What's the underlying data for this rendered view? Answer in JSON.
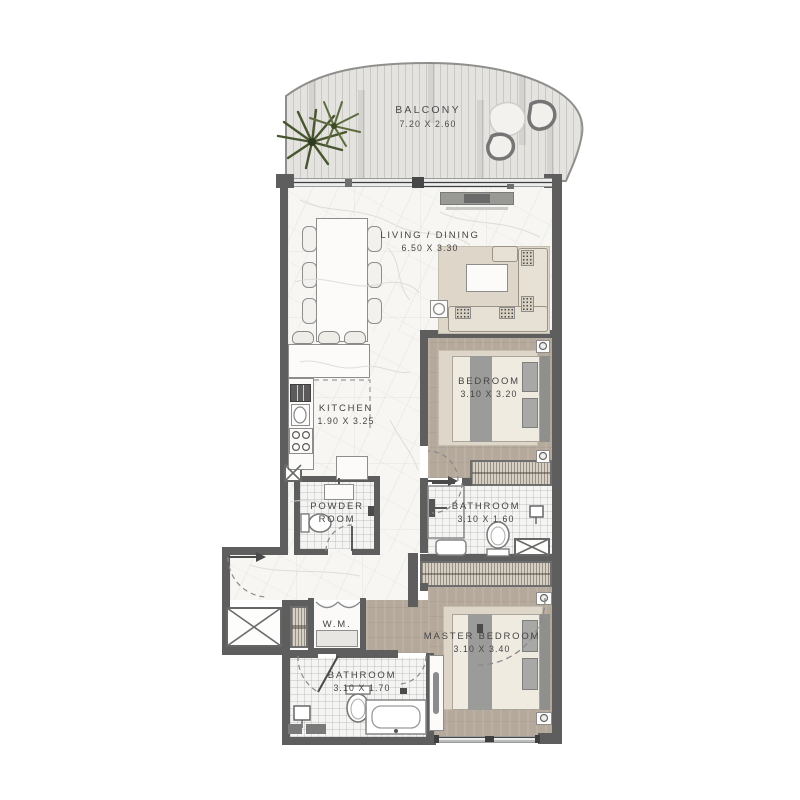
{
  "rooms": {
    "balcony": {
      "label": "BALCONY",
      "dims": "7.20 X 2.60"
    },
    "living_dining": {
      "label": "LIVING / DINING",
      "dims": "6.50 X 3.30"
    },
    "kitchen": {
      "label": "KITCHEN",
      "dims": "1.90 X 3.25"
    },
    "bedroom": {
      "label": "BEDROOM",
      "dims": "3.10 X 3.20"
    },
    "bathroom": {
      "label": "BATHROOM",
      "dims": "3.10 X 1.60"
    },
    "powder_room": {
      "label_line1": "POWDER",
      "label_line2": "ROOM"
    },
    "laundry": {
      "label": "W.M."
    },
    "master_bedroom": {
      "label": "MASTER BEDROOM",
      "dims": "3.10 X 3.40"
    },
    "master_bathroom": {
      "label": "BATHROOM",
      "dims": "3.10 X 1.70"
    }
  },
  "colors": {
    "wall": "#5e5e5e",
    "marble_floor": "#f7f6f3",
    "bedroom_floor": "#b5a99b",
    "balcony_deck": "#e4e3e0",
    "wardrobe": "#d6cfc4",
    "sofa": "#e7e1d5",
    "plant_green": "#4c5b33"
  }
}
